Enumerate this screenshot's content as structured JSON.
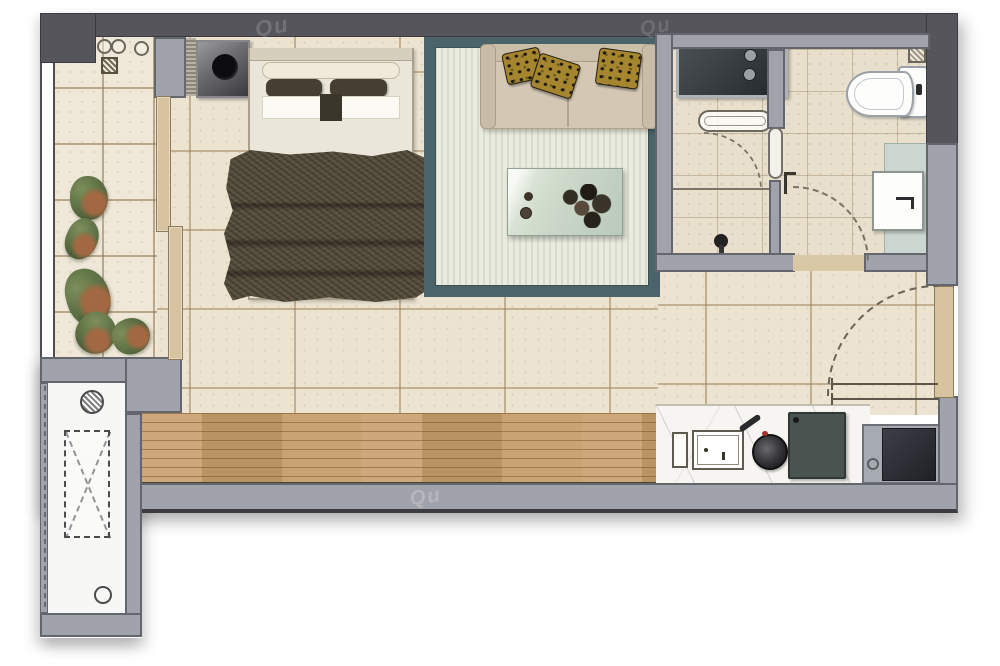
{
  "watermark": {
    "text": "Qu"
  },
  "plan": {
    "type": "studio-apartment-floor-plan",
    "rooms": [
      {
        "name": "balcony",
        "features": [
          "floor-tiles",
          "plants",
          "pipe-symbols",
          "floor-drain",
          "glazing-window",
          "sliding-door"
        ]
      },
      {
        "name": "bedroom-living",
        "features": [
          "washing-machine",
          "double-bed",
          "blanket",
          "area-rug",
          "sofa",
          "throw-pillows",
          "coffee-table"
        ]
      },
      {
        "name": "bathroom",
        "features": [
          "counter-unit",
          "towel-rack",
          "shower-door",
          "partition-door",
          "toilet",
          "wash-basin",
          "vanity-counter",
          "floor-drain",
          "toilet-brush"
        ]
      },
      {
        "name": "kitchen",
        "features": [
          "drainboard",
          "sink",
          "wok-pan",
          "cooktop",
          "refrigerator",
          "marble-counter"
        ]
      },
      {
        "name": "entry",
        "features": [
          "entry-door-leaf",
          "door-swing-arc",
          "threshold-lines"
        ]
      },
      {
        "name": "utility-shaft",
        "features": [
          "duct-cross-symbol",
          "hatched-pipe-circle",
          "drain-circle",
          "dashed-window-line"
        ]
      }
    ],
    "colors": {
      "wall_dark": "#55555b",
      "wall_light": "#a0a3ab",
      "tile_main": "#ece3d1",
      "tile_balcony": "#efe8d9",
      "tile_bath": "#e8e0cd",
      "wood_floor": "#c69e6c",
      "marble_counter": "#f6f5f1",
      "rug_border": "#4a646a",
      "rug_field": "#eaecdf",
      "sofa": "#d4c8b5",
      "bed_linen": "#eae6da",
      "blanket": "#574f3d",
      "pillow_accent": "#a5862f",
      "coffee_table": "#cfdacd",
      "fixture_white": "#fbfbf9",
      "appliance_dark": "#33383c",
      "door_wood": "#d8c3a1",
      "vanity_top": "#cbd6d0",
      "cooktop": "#49534f",
      "plant_green": "#5c7046",
      "plant_rust": "#a8764f"
    }
  }
}
